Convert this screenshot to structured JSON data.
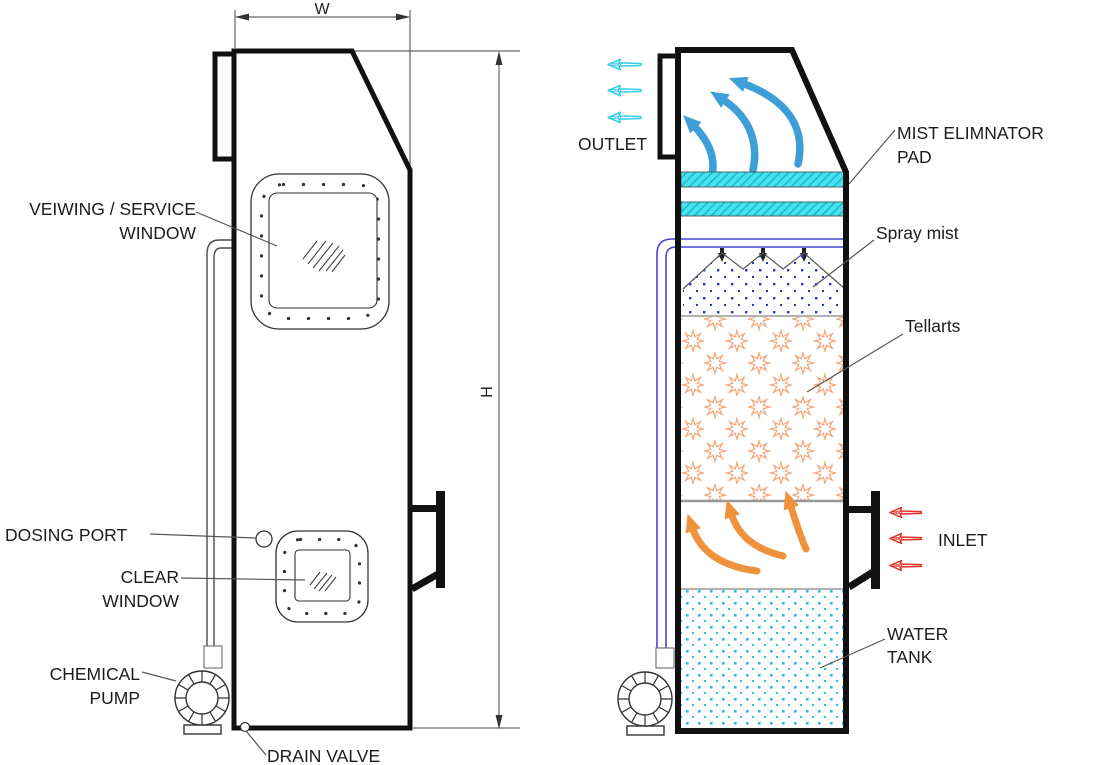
{
  "left_view": {
    "dim_w": "W",
    "dim_h": "H",
    "viewing_l1": "VEIWING / SERVICE",
    "viewing_l2": "WINDOW",
    "dosing": "DOSING PORT",
    "clear_l1": "CLEAR",
    "clear_l2": "WINDOW",
    "pump_l1": "CHEMICAL",
    "pump_l2": "PUMP",
    "drain": "DRAIN VALVE"
  },
  "right_view": {
    "outlet": "OUTLET",
    "mist_l1": "MIST ELIMNATOR",
    "mist_l2": "PAD",
    "spray": "Spray mist",
    "tellarts": "Tellarts",
    "inlet": "INLET",
    "water_l1": "WATER",
    "water_l2": "TANK"
  },
  "colors": {
    "pad-fill": "#45e4f0",
    "pad-hatch": "#1fb9cc",
    "outlet-arrow": "#30cce8",
    "gas-arrow": "#3e9fd8",
    "mist-dot": "#2a35c8",
    "pipe-blue": "#4646d4",
    "tellart": "#f2a87b",
    "orange-arrow": "#f0913b",
    "inlet-red": "#e53228",
    "water-dot": "#38b6ee",
    "label-ink": "#1c1c1c",
    "line-ink": "#111111"
  }
}
